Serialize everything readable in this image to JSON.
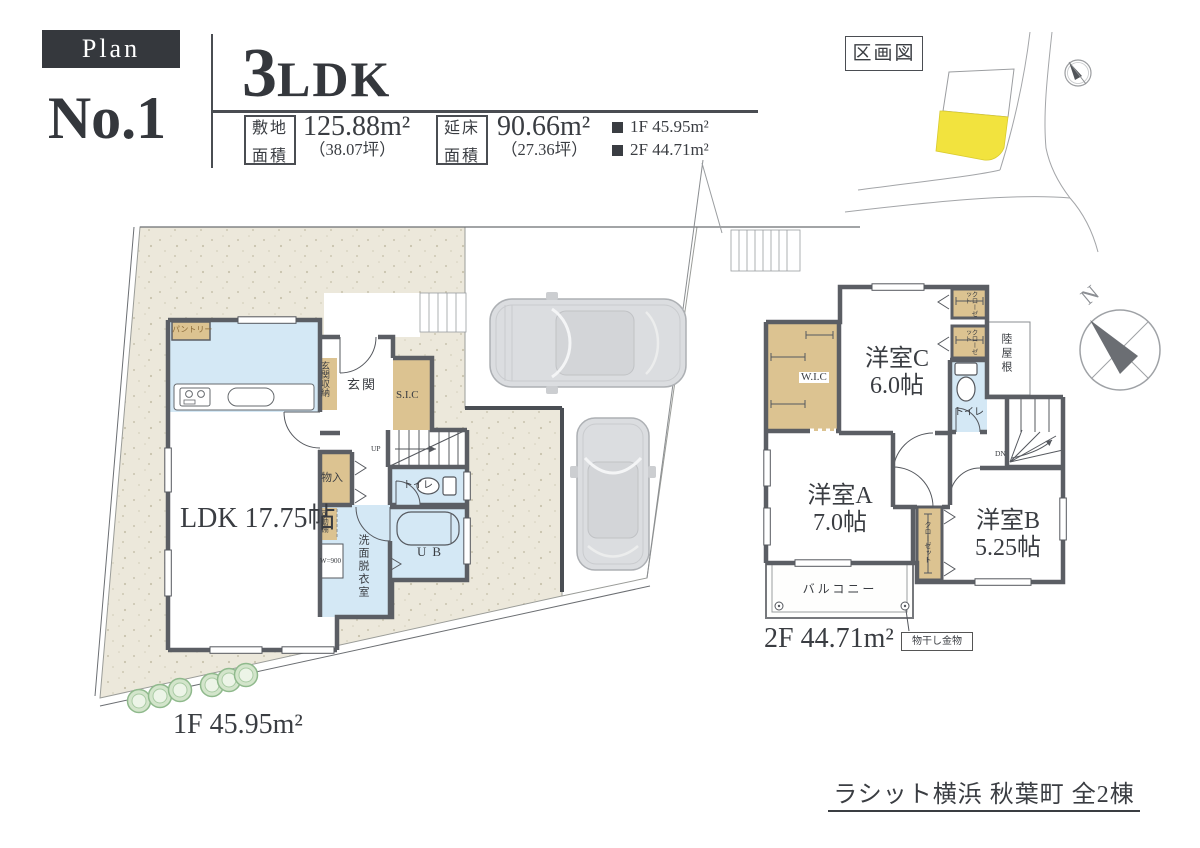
{
  "header": {
    "badge": "Plan",
    "plan_no": "No.1",
    "type_num": "3",
    "type_suffix": "LDK",
    "site_label_top": "敷地",
    "site_label_bottom": "面積",
    "site_area": "125.88m²",
    "site_tsubo": "（38.07坪）",
    "total_label_top": "延床",
    "total_label_bottom": "面積",
    "total_area": "90.66m²",
    "total_tsubo": "（27.36坪）",
    "legend_1f": "1F 45.95m²",
    "legend_2f": "2F 44.71m²"
  },
  "map": {
    "title": "区画図"
  },
  "floor1": {
    "caption": "1F 45.95m²",
    "ldk": "LDK 17.75帖",
    "entrance": "玄関",
    "entrance_storage": "玄関収納",
    "shoe_closet": "S.I.C",
    "pantry": "パントリー",
    "storage": "物入",
    "movable_shelf": "可動棚",
    "washer": "W=900",
    "washroom": "洗面脱衣室",
    "toilet": "トイレ",
    "unit_bath": "UB",
    "stairs_up": "UP"
  },
  "floor2": {
    "caption": "2F 44.71m²",
    "room_c": "洋室C",
    "room_c_size": "6.0帖",
    "room_a": "洋室A",
    "room_a_size": "7.0帖",
    "room_b": "洋室B",
    "room_b_size": "5.25帖",
    "wic": "W.I.C",
    "closet": "クローゼット",
    "toilet": "トイレ",
    "flat_roof": "陸屋根",
    "balcony": "バルコニー",
    "stairs_down": "DN",
    "hanger": "物干し金物",
    "compass_north": "N"
  },
  "footer": {
    "project_title": "ラシット横浜 秋葉町 全2棟"
  },
  "colors": {
    "lot_fill": "#ece8db",
    "highlight_yellow": "#f2e33e",
    "closet_tan": "#dcc391",
    "water_blue": "#d4e8f5",
    "wall_gray": "#5b5e64"
  }
}
